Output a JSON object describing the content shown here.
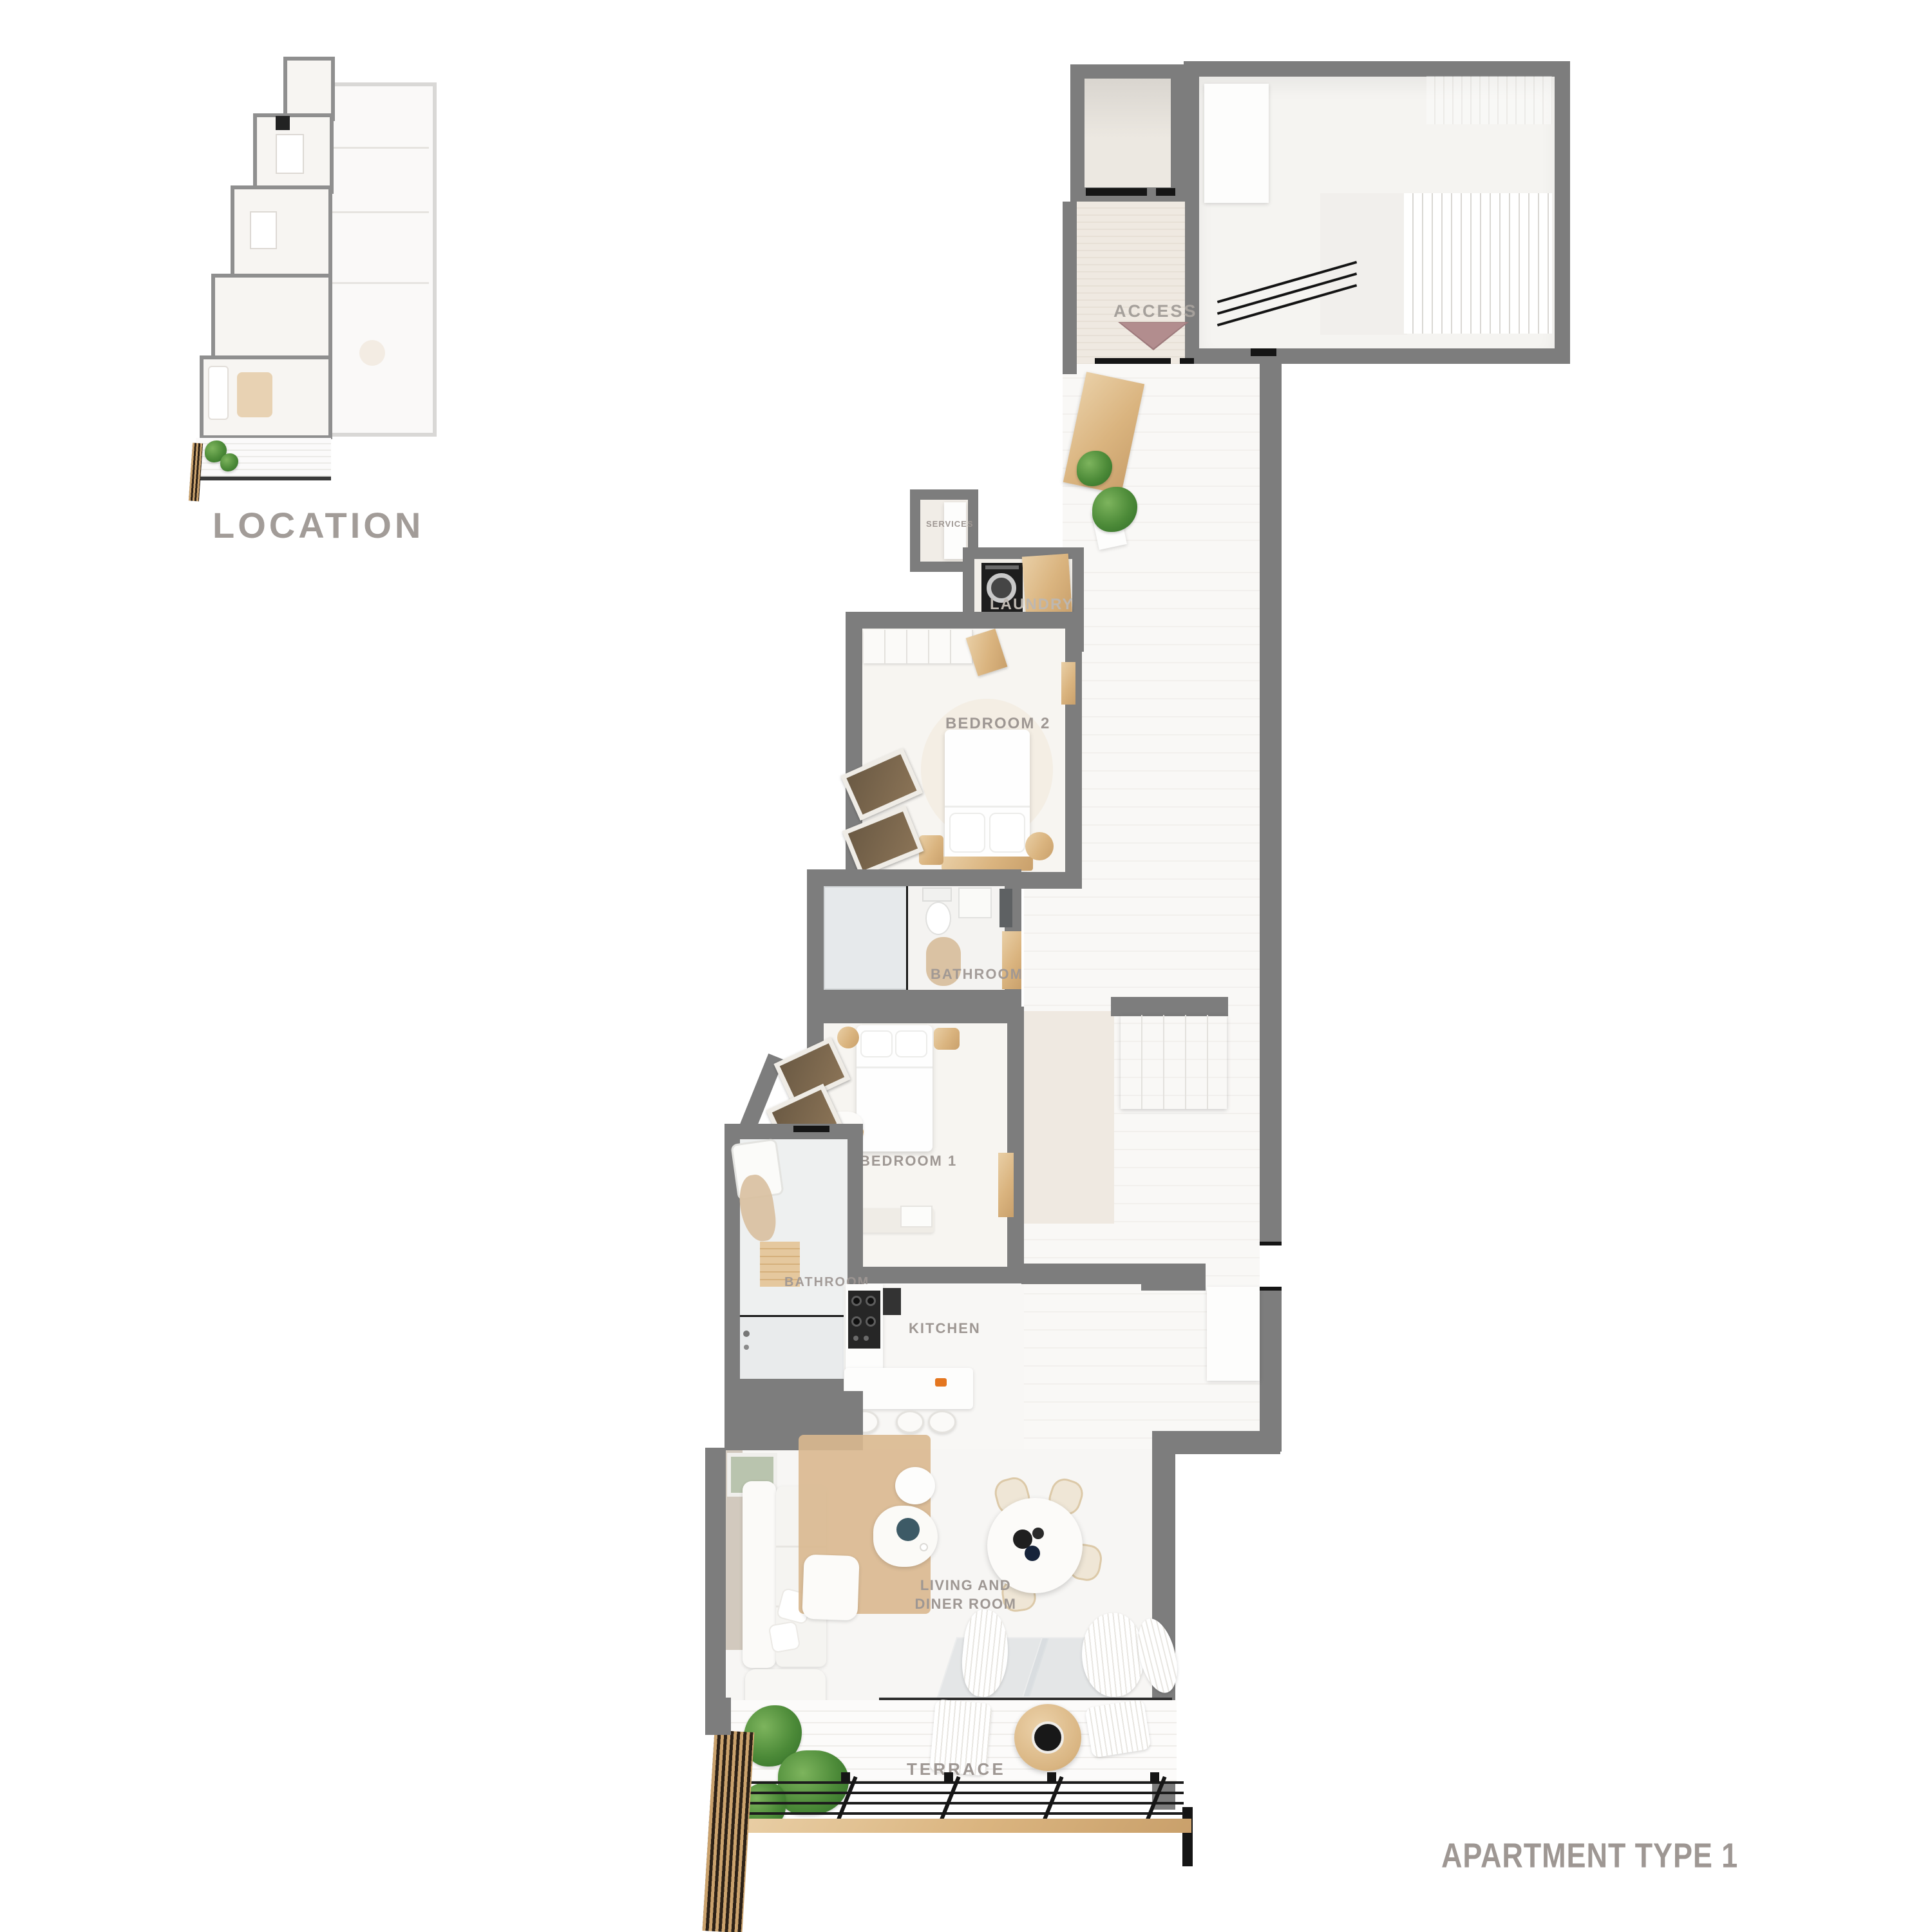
{
  "location_panel": {
    "caption": "LOCATION"
  },
  "floor_plan": {
    "labels": {
      "access": "ACCESS",
      "services": "SERVICES",
      "laundry": "LAUNDRY",
      "bedroom2": "BEDROOM 2",
      "bathroom_upper": "BATHROOM",
      "bedroom1": "BEDROOM 1",
      "bathroom_lower": "BATHROOM",
      "kitchen": "KITCHEN",
      "living_diner": "LIVING AND DINER ROOM",
      "terrace": "TERRACE"
    },
    "icons": {
      "access_arrow": "triangle-down-icon"
    }
  },
  "title": {
    "text": "APARTMENT TYPE 1"
  },
  "colors": {
    "wall": "#7d7d7d",
    "label": "#9e9793",
    "access_arrow": "#b28d8e",
    "wood": "#ddbe95",
    "plant": "#5d9748",
    "floor": "#f6f4f1"
  }
}
